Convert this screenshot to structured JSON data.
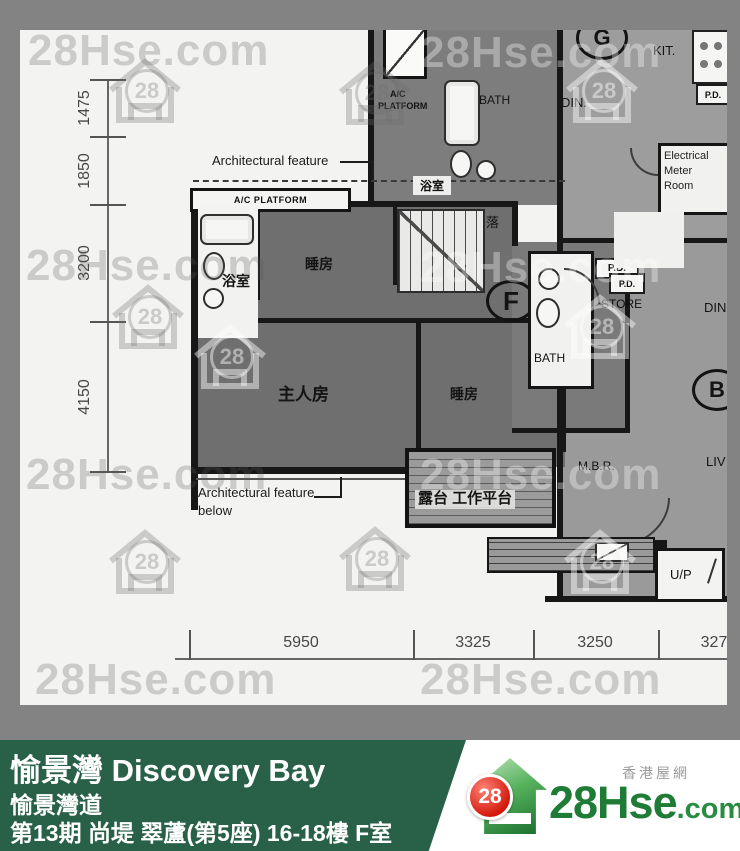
{
  "watermark": {
    "text": "28Hse.com",
    "badge": "28"
  },
  "plan": {
    "dim_left": {
      "d1": "1475",
      "d2": "1850",
      "d3": "3200",
      "d4": "4150"
    },
    "dim_bottom": {
      "d1": "5950",
      "d2": "3325",
      "d3": "3250",
      "d4": "327"
    },
    "labels": {
      "arch_feature": "Architectural feature",
      "arch_feature_below_line1": "Architectural feature",
      "arch_feature_below_line2": "below",
      "ac_platform": "A/C PLATFORM",
      "ac_platform_small_line1": "A/C",
      "ac_platform_small_line2": "PLATFORM",
      "bath_cn_main": "浴室",
      "bath_cn_upper": "浴室",
      "bedroom_upper": "睡房",
      "bedroom_lower": "睡房",
      "master_bedroom": "主人房",
      "balcony": "露台 工作平台",
      "stairs_down": "落",
      "bath_en_upper": "BATH",
      "bath_en_mid": "BATH",
      "dining_upper": "DIN.",
      "dining_right": "DIN",
      "kitchen": "KIT.",
      "store": "STORE",
      "mbr": "M.B.R.",
      "living": "LIV",
      "up": "U/P",
      "emr_line1": "Electrical",
      "emr_line2": "Meter",
      "emr_line3": "Room",
      "pd_upper": "P.D.",
      "pd_store": "P.D.",
      "pd_right": "P.D.",
      "unit_f": "F",
      "unit_g": "G",
      "unit_b": "B"
    }
  },
  "banner": {
    "title": "愉景灣 Discovery Bay",
    "address": "愉景灣道",
    "detail": "第13期 尚堤 翠蘆(第5座) 16-18樓 F室"
  },
  "logo": {
    "badge": "28",
    "name": "28Hse",
    "tld": ".com",
    "tagline": "香港屋網"
  },
  "colors": {
    "banner_green": "#286048",
    "logo_green": "#1e7c36",
    "badge_red": "#d3170c",
    "highlight_unit_gray": "#6f6f6f"
  }
}
